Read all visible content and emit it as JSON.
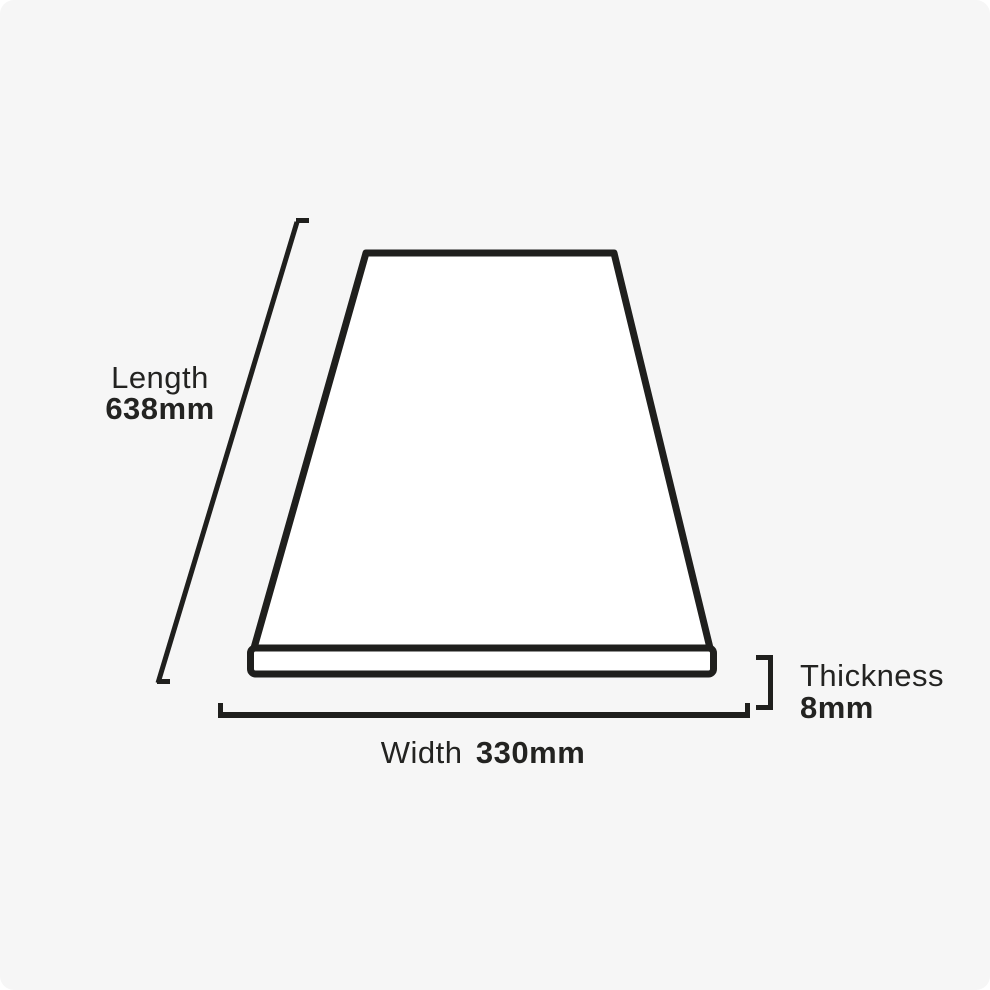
{
  "page": {
    "background_color": "#f6f6f6",
    "ink_color": "#1f1f1d",
    "text_color": "#232321"
  },
  "diagram": {
    "name": "plank-dimensions-diagram",
    "length": {
      "label": "Length",
      "value": "638mm"
    },
    "width": {
      "label": "Width",
      "value": "330mm"
    },
    "thickness": {
      "label": "Thickness",
      "value": "8mm"
    }
  }
}
